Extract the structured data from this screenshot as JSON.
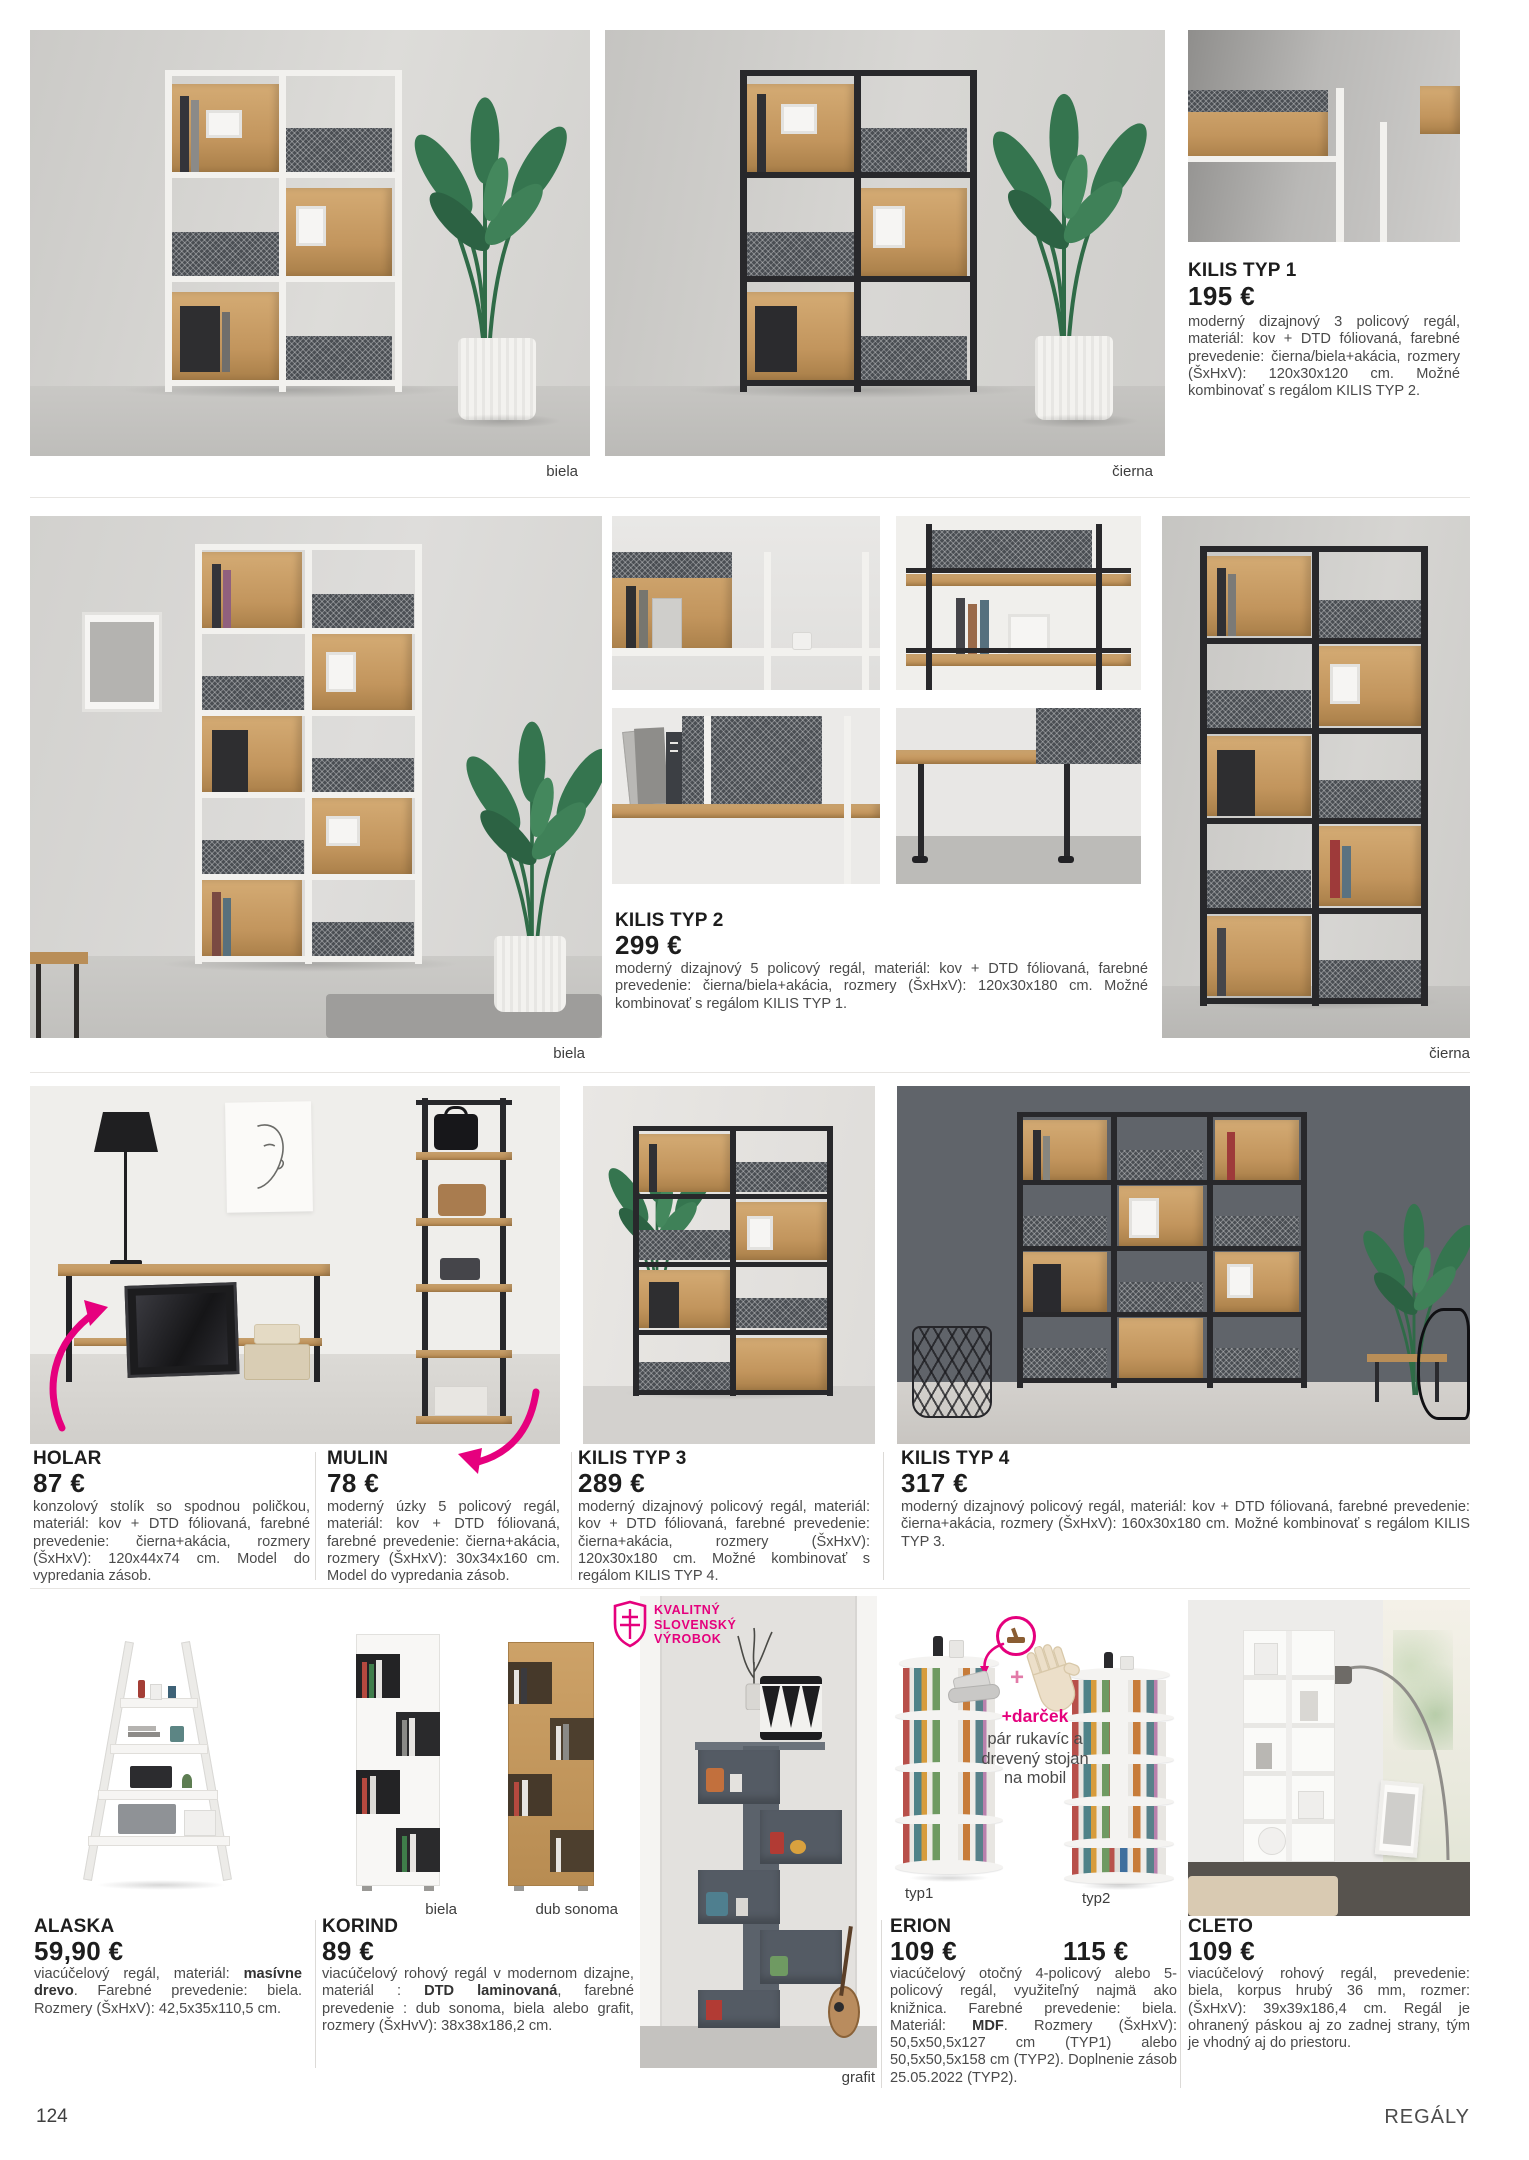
{
  "accent_pink": "#e5007d",
  "icons": {
    "badge": "slovak-double-cross-shield-icon",
    "arrows": "pink-curved-arrow-icon",
    "gift": "gift-circle-icon",
    "glove": "glove-icon",
    "plus": "plus-icon",
    "plant": "plant-icon"
  },
  "footer": {
    "page_number": "124",
    "section": "REGÁLY"
  },
  "row1": {
    "photo_labels": {
      "left": "biela",
      "right": "čierna"
    },
    "kilis1": {
      "name": "KILIS TYP 1",
      "price": "195 €",
      "description": "moderný dizajnový 3 policový regál, materiál: kov + DTD fóliovaná, farebné prevedenie: čierna/biela+akácia, rozmery (ŠxHxV): 120x30x120 cm. Možné kombinovať s regálom KILIS TYP 2."
    }
  },
  "row2": {
    "photo_labels": {
      "left": "biela",
      "right": "čierna"
    },
    "kilis2": {
      "name": "KILIS TYP 2",
      "price": "299 €",
      "description": "moderný dizajnový 5 policový regál, materiál: kov + DTD fóliovaná, farebné prevedenie: čierna/biela+akácia, rozmery (ŠxHxV): 120x30x180 cm. Možné kombinovať s regálom KILIS TYP 1."
    }
  },
  "row3": {
    "holar": {
      "name": "HOLAR",
      "price": "87 €",
      "description": "konzolový stolík so spodnou poličkou, materiál: kov + DTD fóliovaná, farebné prevedenie: čierna+akácia, rozmery (ŠxHxV): 120x44x74 cm. Model do vypredania zásob."
    },
    "mulin": {
      "name": "MULIN",
      "price": "78 €",
      "description": "moderný úzky 5 policový regál, materiál: kov + DTD fóliovaná, farebné prevedenie: čierna+akácia, rozmery (ŠxHxV): 30x34x160 cm. Model do vypredania zásob."
    },
    "kilis3": {
      "name": "KILIS TYP 3",
      "price": "289 €",
      "description": "moderný dizajnový policový regál, materiál: kov + DTD fóliovaná, farebné prevedenie: čierna+akácia, rozmery (ŠxHxV): 120x30x180 cm. Možné kombinovať s regálom KILIS TYP 4."
    },
    "kilis4": {
      "name": "KILIS TYP 4",
      "price": "317 €",
      "description": "moderný dizajnový policový regál, materiál: kov + DTD fóliovaná, farebné prevedenie: čierna+akácia, rozmery (ŠxHxV): 160x30x180 cm. Možné kombinovať s regálom KILIS TYP 3."
    }
  },
  "row4": {
    "alaska": {
      "name": "ALASKA",
      "price": "59,90 €",
      "description_rich": [
        {
          "t": "viacúčelový regál, materiál: "
        },
        {
          "t": "masívne drevo",
          "b": true
        },
        {
          "t": ". Farebné prevedenie: biela. Rozmery (ŠxHxV): 42,5x35x110,5 cm."
        }
      ]
    },
    "korind": {
      "name": "KORIND",
      "price": "89 €",
      "labels": {
        "left": "biela",
        "right": "dub sonoma"
      },
      "description_rich": [
        {
          "t": "viacúčelový rohový regál v modernom dizajne, materiál : "
        },
        {
          "t": "DTD laminovaná",
          "b": true
        },
        {
          "t": ", farebné prevedenie : dub sonoma, biela alebo grafit, rozmery (ŠxHvV): 38x38x186,2 cm."
        }
      ]
    },
    "badge": {
      "line1": "KVALITNÝ",
      "line2": "SLOVENSKÝ",
      "line3": "VÝROBOK"
    },
    "grafit_label": "grafit",
    "erion": {
      "name": "ERION",
      "price_typ1": "109 €",
      "price_typ2": "115 €",
      "label_typ1": "typ1",
      "label_typ2": "typ2",
      "gift_title": "+darček",
      "gift_line1": "pár rukavíc a",
      "gift_line2": "drevený stojan",
      "gift_line3": "na mobil",
      "description_rich": [
        {
          "t": "viacúčelový otočný 4-policový alebo 5-policový regál, využiteľný najmä ako knižnica. Farebné prevedenie: biela. Materiál: "
        },
        {
          "t": "MDF",
          "b": true
        },
        {
          "t": ". Rozmery (ŠxHxV): 50,5x50,5x127 cm (TYP1) alebo 50,5x50,5x158 cm (TYP2). Doplnenie zásob 25.05.2022 (TYP2)."
        }
      ]
    },
    "cleto": {
      "name": "CLETO",
      "price": "109 €",
      "description": "viacúčelový rohový regál, prevedenie: biela, korpus hrubý 36 mm, rozmer: (ŠxHxV): 39x39x186,4 cm. Regál je ohranený páskou aj zo zadnej strany, tým je vhodný aj do priestoru."
    }
  }
}
